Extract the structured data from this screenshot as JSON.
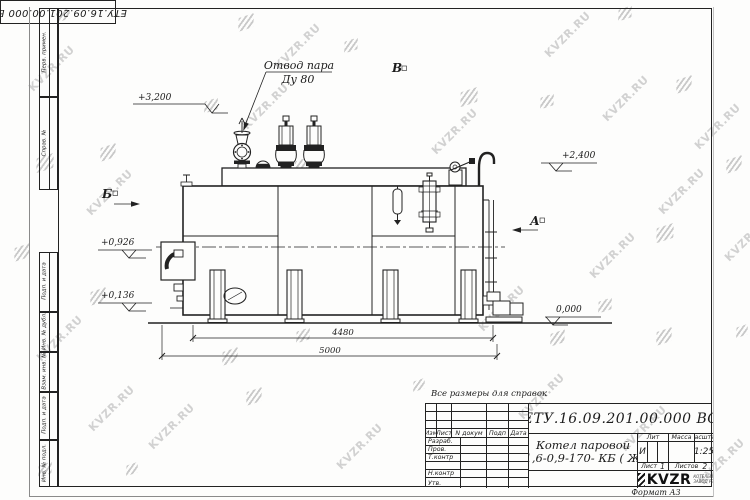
{
  "colors": {
    "ink": "#222222",
    "paper": "#fdfdfc",
    "watermark_text": "#c7c7c7",
    "watermark_logo": "#b3b3b3"
  },
  "watermark": {
    "text": "KVZR.RU"
  },
  "corner_stamp": {
    "doc_number": "ЕТУ.16.09.201.00.000  ВО"
  },
  "left_frame_columns": [
    {
      "label": "Перв. примен."
    },
    {
      "label": "Справ. №"
    },
    {
      "label": "Подп. и дата"
    },
    {
      "label": "Инв. № дубл."
    },
    {
      "label": "Взам. инв. №"
    },
    {
      "label": "Подп. и дата"
    },
    {
      "label": "Инв. № подл."
    }
  ],
  "drawing": {
    "callout": {
      "line1": "Отвод пара",
      "line2": "Ду 80"
    },
    "views": {
      "b": "Б",
      "v": "В",
      "a": "А"
    },
    "elevations": {
      "e3200": "+3,200",
      "e2400": "+2,400",
      "e0926": "+0,926",
      "e0136": "+0,136",
      "e0": "0,000"
    },
    "dimensions": {
      "d1": "4480",
      "d2": "5000"
    }
  },
  "note": "Все размеры для справок",
  "title_block": {
    "doc_number": "ЕТУ.16.09.201.00.000  ВО",
    "product_line1": "Котел паровой",
    "product_line2": "Е -1,6-0,9-170- КБ ( ЖК )",
    "cols": {
      "izm": "Изм",
      "list": "Лист",
      "ndoc": "N докум",
      "podp": "Подп",
      "data": "Дата"
    },
    "rows": {
      "razrab": "Разраб.",
      "prov": "Пров.",
      "tkontr": "Т.контр",
      "nkontr": "Н.контр",
      "utv": "Утв."
    },
    "lit_label": "Лит",
    "lit_value": "И",
    "mass_label": "Масса",
    "mass_value": "",
    "scale_label": "Масштаб",
    "scale_value": "1:25",
    "sheet_label": "Лист",
    "sheet_value": "1",
    "sheets_label": "Листов",
    "sheets_value": "2",
    "company_name": "KVZR",
    "company_tag1": "КОТЕЛЬНЫЙ",
    "company_tag2": "ЗАВОД РЭП",
    "format_label": "Формат А3"
  }
}
